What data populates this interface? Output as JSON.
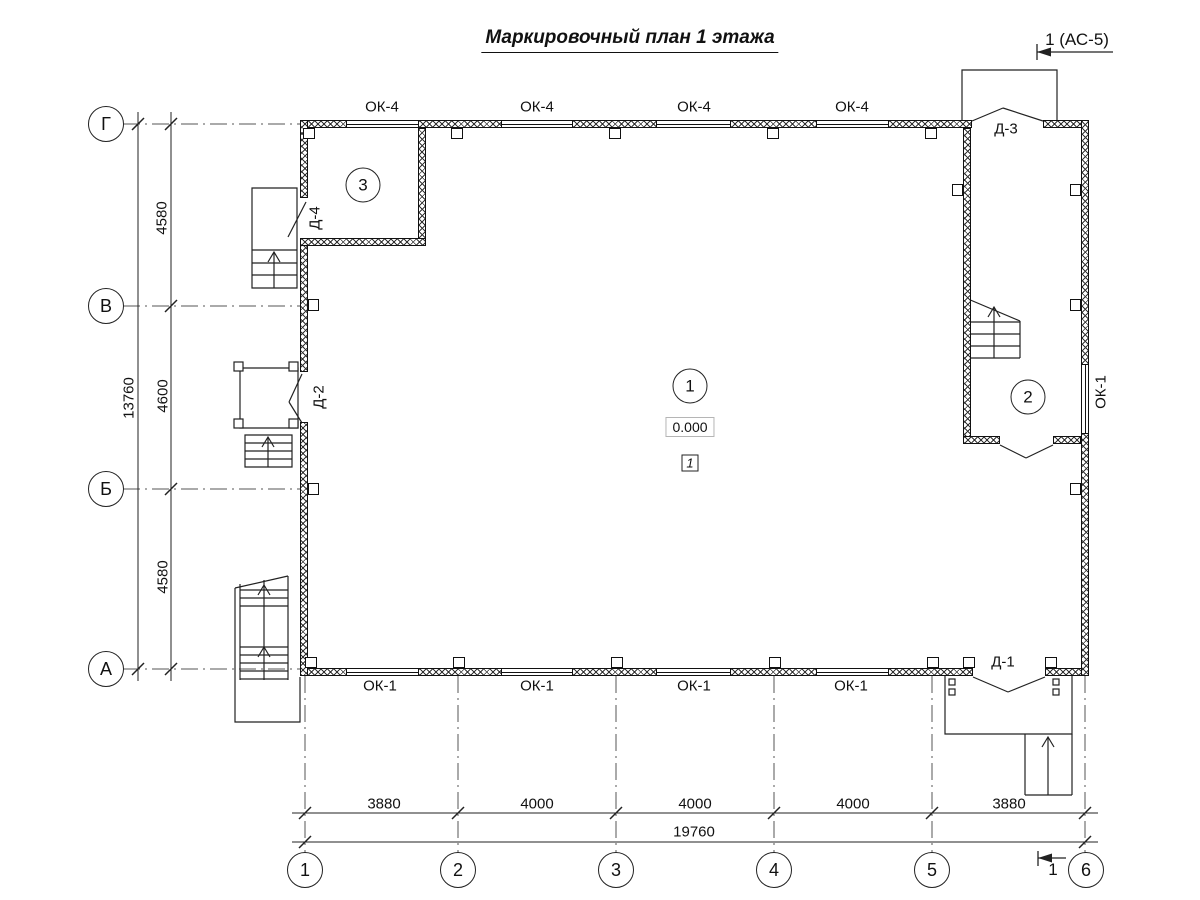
{
  "title": "Маркировочный план 1 этажа",
  "section_marks": {
    "top_label": "1 (АС-5)",
    "bottom_label": "1"
  },
  "axes": {
    "rows": [
      {
        "label": "Г"
      },
      {
        "label": "В"
      },
      {
        "label": "Б"
      },
      {
        "label": "А"
      }
    ],
    "cols": [
      {
        "label": "1"
      },
      {
        "label": "2"
      },
      {
        "label": "3"
      },
      {
        "label": "4"
      },
      {
        "label": "5"
      },
      {
        "label": "6"
      }
    ]
  },
  "dimensions": {
    "left_segments": [
      {
        "value": "4580"
      },
      {
        "value": "4600"
      },
      {
        "value": "4580"
      }
    ],
    "left_total": "13760",
    "bottom_segments": [
      {
        "value": "3880"
      },
      {
        "value": "4000"
      },
      {
        "value": "4000"
      },
      {
        "value": "4000"
      },
      {
        "value": "3880"
      }
    ],
    "bottom_total": "19760"
  },
  "windows": {
    "top_labels": [
      {
        "label": "ОК-4"
      },
      {
        "label": "ОК-4"
      },
      {
        "label": "ОК-4"
      },
      {
        "label": "ОК-4"
      }
    ],
    "bottom_labels": [
      {
        "label": "ОК-1"
      },
      {
        "label": "ОК-1"
      },
      {
        "label": "ОК-1"
      },
      {
        "label": "ОК-1"
      }
    ],
    "right_label": "ОК-1"
  },
  "doors": {
    "d1": "Д-1",
    "d2": "Д-2",
    "d3": "Д-3",
    "d4": "Д-4"
  },
  "rooms": [
    {
      "number": "1"
    },
    {
      "number": "2"
    },
    {
      "number": "3"
    }
  ],
  "marks": {
    "elevation": "0.000",
    "zone_number": "1"
  }
}
